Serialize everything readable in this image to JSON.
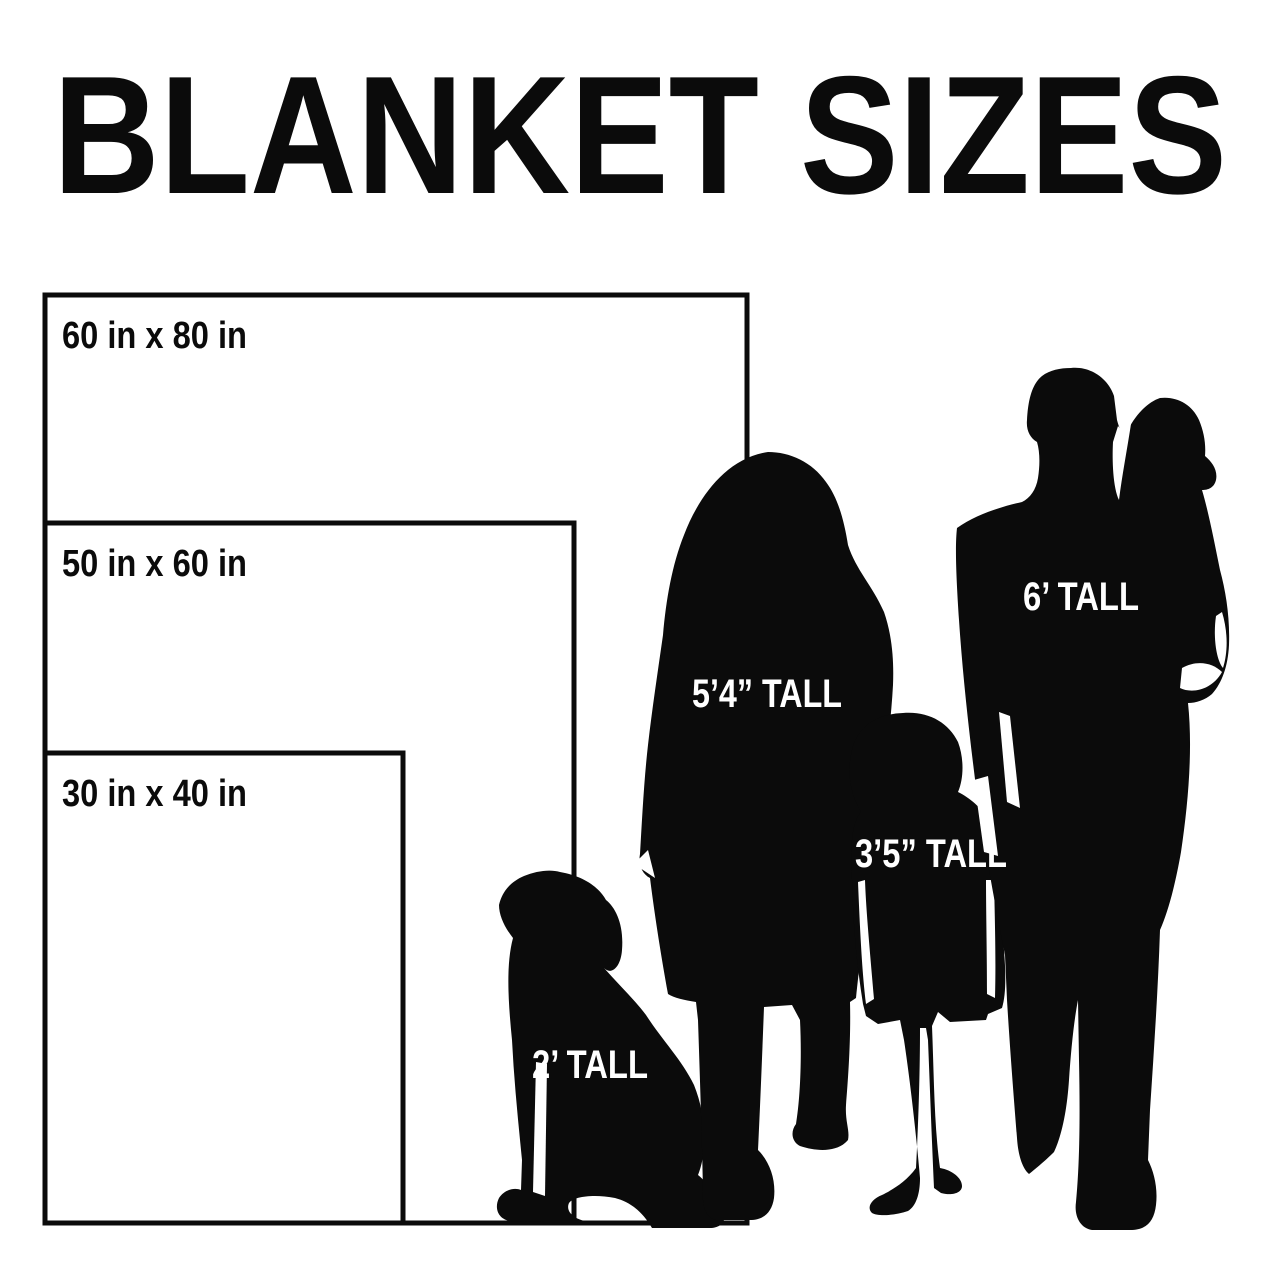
{
  "title": "BLANKET SIZES",
  "blankets": [
    {
      "label": "60 in x 80 in",
      "width_in": 60,
      "length_in": 80
    },
    {
      "label": "50 in x 60 in",
      "width_in": 50,
      "length_in": 60
    },
    {
      "label": "30 in x 40 in",
      "width_in": 30,
      "length_in": 40
    }
  ],
  "figures": [
    {
      "name": "dog",
      "label": "2’ TALL"
    },
    {
      "name": "woman",
      "label": "5’4” TALL"
    },
    {
      "name": "girl",
      "label": "3’5” TALL"
    },
    {
      "name": "man",
      "label": "6’ TALL"
    }
  ],
  "colors": {
    "ink": "#0b0b0b",
    "background": "#ffffff",
    "label_text": "#ffffff"
  }
}
